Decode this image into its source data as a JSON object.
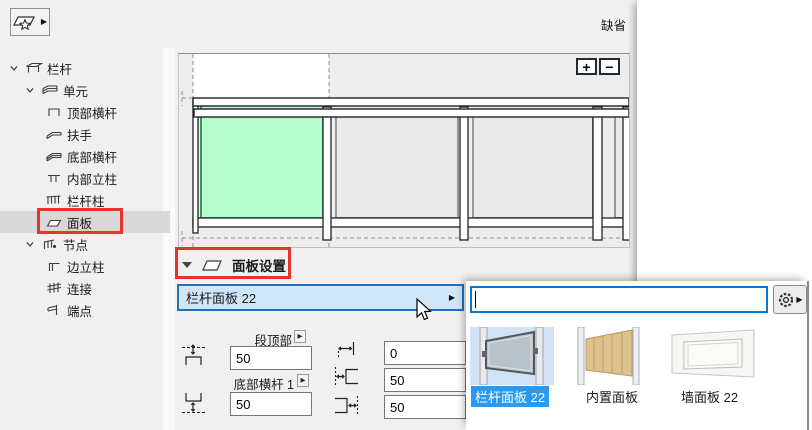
{
  "window": {
    "default_label": "缺省"
  },
  "icons": {
    "flyout_arrow": "▶",
    "zoom_in": "+",
    "zoom_out": "−"
  },
  "tree": {
    "items": [
      {
        "label": "栏杆",
        "level": 0,
        "expanded": true
      },
      {
        "label": "单元",
        "level": 1,
        "expanded": true
      },
      {
        "label": "顶部横杆",
        "level": 2
      },
      {
        "label": "扶手",
        "level": 2
      },
      {
        "label": "底部横杆",
        "level": 2
      },
      {
        "label": "内部立柱",
        "level": 2
      },
      {
        "label": "栏杆柱",
        "level": 2
      },
      {
        "label": "面板",
        "level": 2,
        "selected": true,
        "annotated": true
      },
      {
        "label": "节点",
        "level": 1,
        "expanded": true
      },
      {
        "label": "边立柱",
        "level": 2
      },
      {
        "label": "连接",
        "level": 2
      },
      {
        "label": "端点",
        "level": 2
      }
    ]
  },
  "panel_settings": {
    "title": "面板设置",
    "dropdown_value": "栏杆面板 22"
  },
  "dimensions": {
    "top_label": "段顶部",
    "top_value": "50",
    "bottom_label": "底部横杆 1",
    "bottom_value": "50",
    "offset_value_1": "0",
    "offset_value_2": "50",
    "offset_value_3": "50"
  },
  "popup": {
    "search_value": "",
    "thumbnails": [
      {
        "label": "栏杆面板 22",
        "selected": true
      },
      {
        "label": "内置面板",
        "selected": false
      },
      {
        "label": "墙面板 22",
        "selected": false
      }
    ]
  },
  "colors": {
    "selection_blue": "#2b99f0",
    "dropdown_bg": "#cfe5f8",
    "dropdown_border": "#2470b8",
    "input_border": "#0b76cf",
    "annotation_red": "#e5342a",
    "panel_green": "#b4fccb",
    "panel_green_border": "#157f35",
    "window_bg": "#f0f0f0"
  }
}
